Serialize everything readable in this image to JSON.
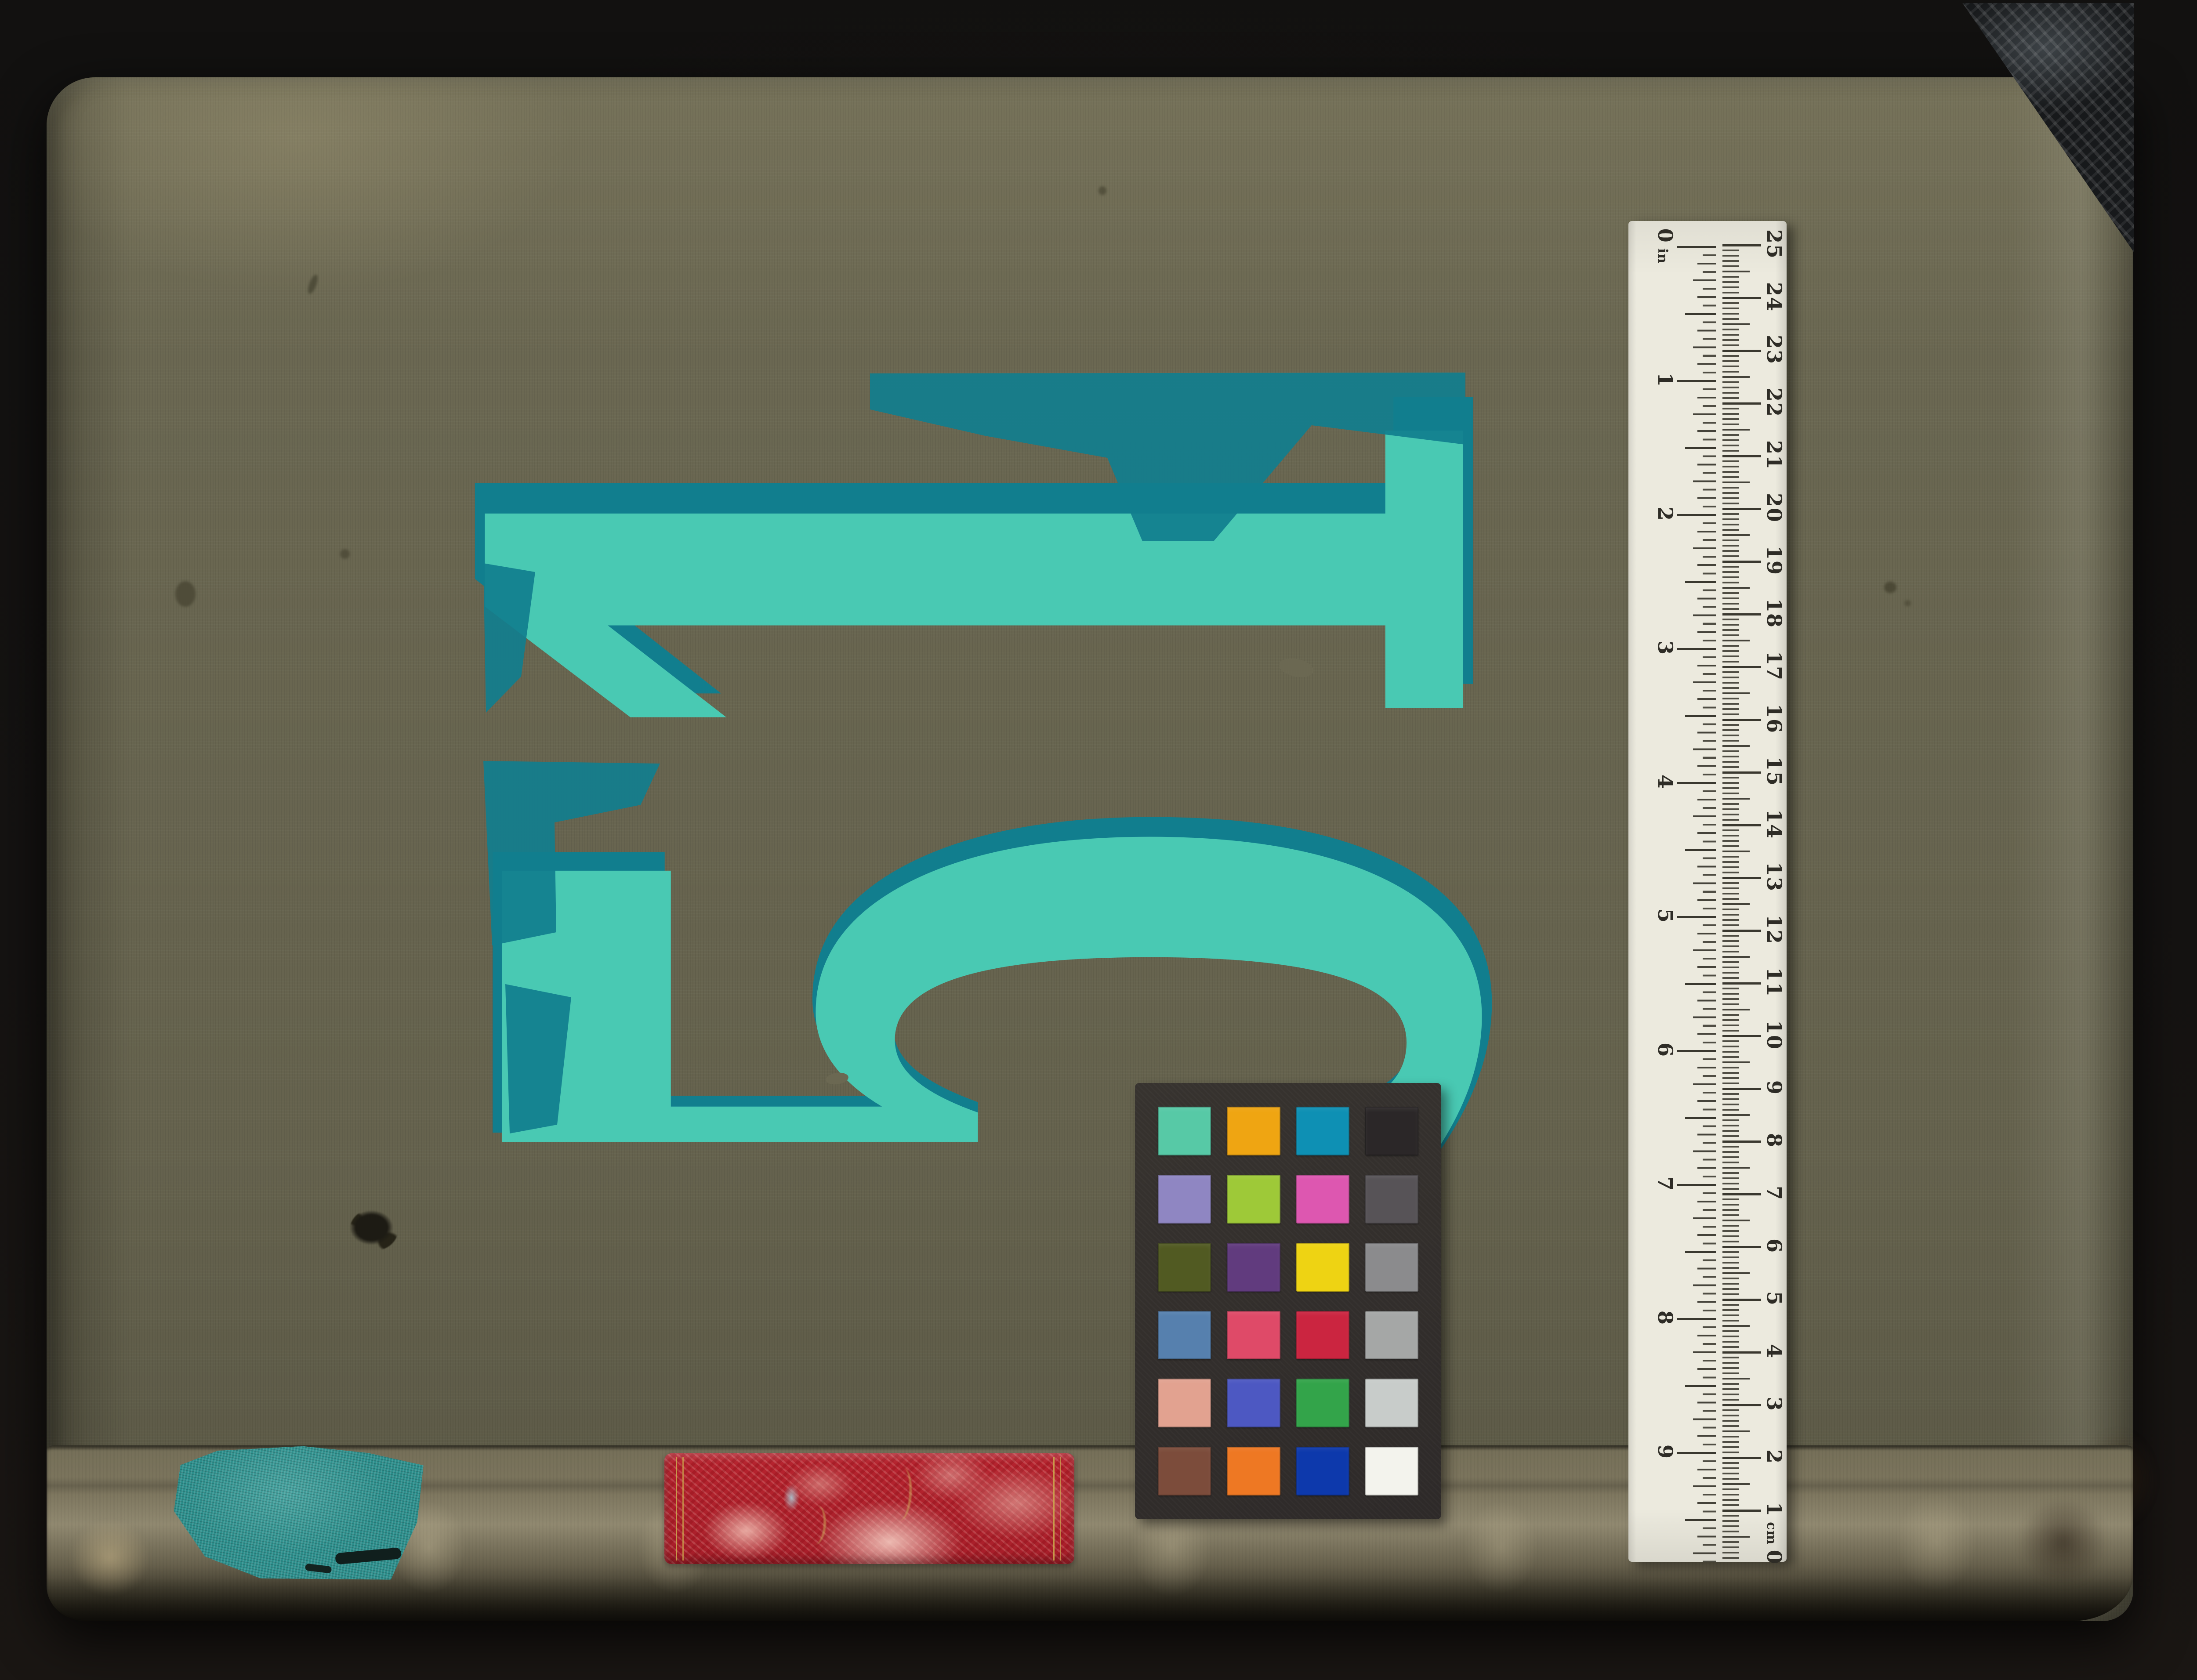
{
  "background_color": "#131110",
  "book": {
    "cover_color": "#6B6852",
    "number": "51",
    "number_color": "#49C9B3",
    "number_undercoat_color": "#117E8E",
    "corner_tape_color": "#17191B"
  },
  "spine": {
    "base_color": "#7E7760",
    "label_color": "#B6232E",
    "label_accent_color": "#CDAC4E",
    "patch_color": "#2B8F8C"
  },
  "ruler": {
    "background_color": "#ECEADE",
    "tick_color": "#3A382F",
    "inch_scale": {
      "unit": "in",
      "labels": [
        "0",
        "1",
        "2",
        "3",
        "4",
        "5",
        "6",
        "7",
        "8",
        "9"
      ]
    },
    "cm_scale": {
      "unit": "cm",
      "labels_top_to_bottom": [
        "25",
        "24",
        "23",
        "22",
        "21",
        "20",
        "19",
        "18",
        "17",
        "16",
        "15",
        "14",
        "13",
        "12",
        "11",
        "10",
        "9",
        "8",
        "7",
        "6",
        "5",
        "4",
        "3",
        "2",
        "1",
        "0"
      ]
    }
  },
  "color_card": {
    "background_color": "#34302E",
    "swatch_rows": [
      [
        "#57C9A6",
        "#EFA512",
        "#0E90B4",
        "#2B2728"
      ],
      [
        "#8F86C2",
        "#9EC938",
        "#DD57B0",
        "#575357"
      ],
      [
        "#515A22",
        "#613B7E",
        "#EED313",
        "#8B8B8D"
      ],
      [
        "#5680AE",
        "#DF4A68",
        "#CB2540",
        "#A5A7A6"
      ],
      [
        "#E2A290",
        "#4D58C2",
        "#33A44A",
        "#C8CCCA"
      ],
      [
        "#7C4C3B",
        "#EE7823",
        "#0D39AC",
        "#F3F3ED"
      ]
    ]
  }
}
